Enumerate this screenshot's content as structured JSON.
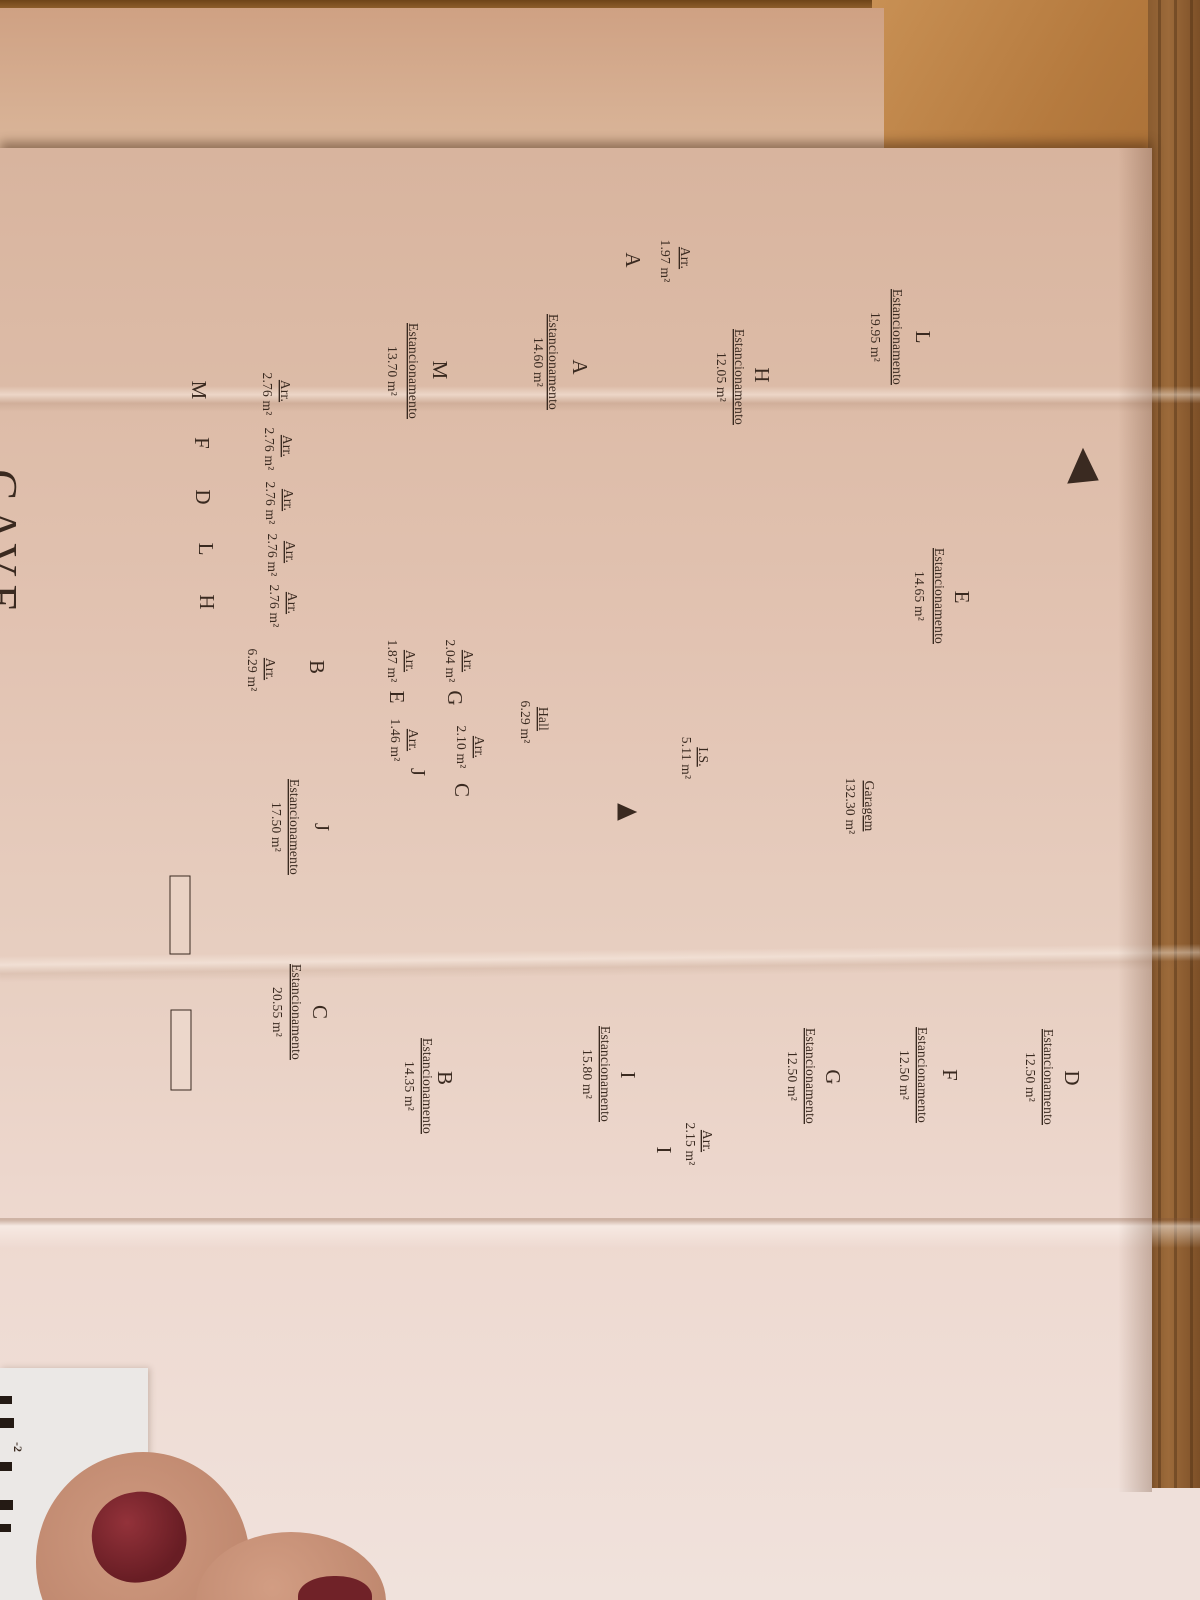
{
  "photo": {
    "floor_title_partial": "CAVE",
    "corner_fragment": "-2"
  },
  "labels": {
    "parking": "Estancionamento",
    "storage": "Arr."
  },
  "parking": {
    "L": {
      "letter": "L",
      "area": "19.95 m²"
    },
    "M": {
      "letter": "M",
      "area": "13.70 m²"
    },
    "A": {
      "letter": "A",
      "area": "14.60 m²"
    },
    "H": {
      "letter": "H",
      "area": "12.05 m²"
    },
    "E": {
      "letter": "E",
      "area": "14.65 m²"
    },
    "J": {
      "letter": "J",
      "area": "17.50 m²"
    },
    "C": {
      "letter": "C",
      "area": "20.55 m²"
    },
    "B": {
      "letter": "B",
      "area": "14.35 m²"
    },
    "I": {
      "letter": "I",
      "area": "15.80 m²"
    },
    "G": {
      "letter": "G",
      "area": "12.50 m²"
    },
    "F": {
      "letter": "F",
      "area": "12.50 m²"
    },
    "D": {
      "letter": "D",
      "area": "12.50 m²"
    }
  },
  "storage": {
    "A": {
      "letter": "A",
      "area": "1.97 m²"
    },
    "M": {
      "letter": "M",
      "area": "2.76 m²"
    },
    "F": {
      "letter": "F",
      "area": "2.76 m²"
    },
    "D": {
      "letter": "D",
      "area": "2.76 m²"
    },
    "L": {
      "letter": "L",
      "area": "2.76 m²"
    },
    "H": {
      "letter": "H",
      "area": "2.76 m²"
    },
    "B": {
      "letter": "B",
      "area": "6.29 m²"
    },
    "E": {
      "letter": "E",
      "area": "1.87 m²"
    },
    "G": {
      "letter": "G",
      "area": "2.04 m²"
    },
    "J": {
      "letter": "J",
      "area": "1.46 m²"
    },
    "C": {
      "letter": "C",
      "area": "2.10 m²"
    },
    "I": {
      "letter": "I",
      "area": "2.15 m²"
    }
  },
  "rooms": {
    "hall": {
      "label": "Hall",
      "area": "6.29 m²"
    },
    "wc": {
      "label": "I.S.",
      "area": "5.11 m²"
    },
    "garage": {
      "label": "Garagem",
      "area": "132.30 m²"
    }
  }
}
